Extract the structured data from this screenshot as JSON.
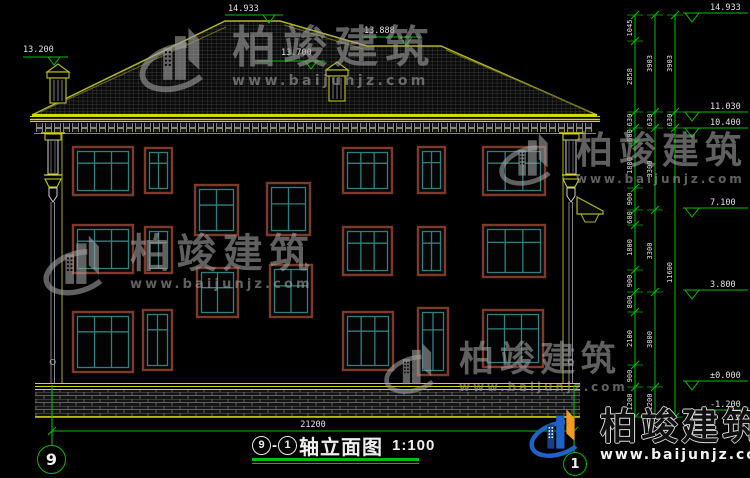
{
  "title_block": {
    "axis_start": "9",
    "separator": "-",
    "axis_end": "1",
    "title": "轴立面图",
    "scale": "1:100"
  },
  "axis_bubbles": [
    {
      "label": "9"
    },
    {
      "label": "1"
    }
  ],
  "watermark": {
    "brand": "柏竣建筑",
    "url": "www.baijunjz.com"
  },
  "colors": {
    "bg": "#000000",
    "green": "#00bf00",
    "label": "#e2e2e2",
    "yellow": "#d6d600",
    "olive": "#b2b226",
    "dim_yellow": "#8f8f20",
    "frame": "#7d3a28",
    "mullion": "#2e8080",
    "dentil": "#969696",
    "brick_line": "#7a7a7a",
    "tile_line": "#3f3f3f",
    "logo_blue": "#1e63c8",
    "logo_dark_blue": "#173f85",
    "logo_orange": "#f49a1c"
  },
  "dims": {
    "bottom": {
      "label": "21200",
      "y": 431,
      "x1": 52,
      "x2": 574
    },
    "axis_lines": [
      {
        "x": 52,
        "y1": 385,
        "y2": 446
      },
      {
        "x": 574,
        "y1": 385,
        "y2": 453
      }
    ],
    "chains": [
      {
        "x": 635,
        "ys": [
          15,
          41,
          112,
          128,
          143,
          188,
          210,
          225,
          270,
          292,
          312,
          365,
          387,
          417
        ],
        "labels": [
          "1045",
          "2858",
          "630",
          "600",
          "1800",
          "900",
          "600",
          "1800",
          "900",
          "800",
          "2100",
          "900",
          "1200"
        ]
      },
      {
        "x": 655,
        "ys": [
          15,
          112,
          128,
          210,
          292,
          387,
          417
        ],
        "labels": [
          "3903",
          "630",
          "3300",
          "3300",
          "3800",
          "1200"
        ]
      },
      {
        "x": 675,
        "ys": [
          15,
          112,
          128,
          417
        ],
        "labels": [
          "3903",
          "630",
          "11600"
        ]
      }
    ]
  },
  "elevations": {
    "right": [
      {
        "label": "14.933",
        "y": 13
      },
      {
        "label": "11.030",
        "y": 112
      },
      {
        "label": "10.400",
        "y": 128
      },
      {
        "label": "7.100",
        "y": 208
      },
      {
        "label": "3.800",
        "y": 290
      },
      {
        "label": "±0.000",
        "y": 381
      },
      {
        "label": "-1.200",
        "y": 410
      }
    ],
    "left": [
      {
        "label": "13.200",
        "tx": 23,
        "ty": 52,
        "x1": 23,
        "x2": 68,
        "y": 57
      },
      {
        "label": "14.933",
        "tx": 228,
        "ty": 11,
        "x1": 225,
        "x2": 283,
        "y": 15
      },
      {
        "label": "13.888",
        "tx": 364,
        "ty": 33,
        "x1": 362,
        "x2": 420,
        "y": 37
      },
      {
        "label": "13.700",
        "tx": 281,
        "ty": 55,
        "x1": 257,
        "x2": 325,
        "y": 61
      }
    ]
  },
  "drawing": {
    "roof": {
      "outline": [
        [
          32,
          115
        ],
        [
          225,
          21
        ],
        [
          280,
          21
        ],
        [
          367,
          46
        ],
        [
          441,
          46
        ],
        [
          597,
          115
        ]
      ],
      "inner_lines": [
        [
          40,
          112,
          226,
          27
        ],
        [
          284,
          25,
          363,
          49
        ],
        [
          446,
          50,
          591,
          112
        ]
      ]
    },
    "chimneys": [
      {
        "cx": 58,
        "top": 64,
        "base": 103
      },
      {
        "cx": 337,
        "top": 62,
        "base": 101
      }
    ],
    "cornice": {
      "x1": 30,
      "x2": 600
    },
    "wall": {
      "x1": 62,
      "x2": 563,
      "top": 134,
      "bottom": 383
    },
    "base": {
      "x1": 35,
      "x2": 580,
      "band_top": 383,
      "brick_top": 390,
      "bottom": 417
    },
    "pilasters": [
      {
        "x": 43
      },
      {
        "x": 561
      }
    ],
    "porch": {
      "roof": [
        [
          577,
          197
        ],
        [
          603,
          211
        ],
        [
          603,
          214
        ],
        [
          577,
          214
        ]
      ],
      "bracket": [
        [
          581,
          214
        ],
        [
          599,
          214
        ],
        [
          595,
          222
        ],
        [
          585,
          222
        ]
      ]
    },
    "windows": [
      {
        "x": 73,
        "y": 147,
        "w": 60,
        "h": 48,
        "t": "L"
      },
      {
        "x": 145,
        "y": 148,
        "w": 27,
        "h": 45,
        "t": "N"
      },
      {
        "x": 343,
        "y": 148,
        "w": 49,
        "h": 45,
        "t": "L"
      },
      {
        "x": 418,
        "y": 147,
        "w": 27,
        "h": 46,
        "t": "N"
      },
      {
        "x": 483,
        "y": 147,
        "w": 62,
        "h": 48,
        "t": "L"
      },
      {
        "x": 195,
        "y": 185,
        "w": 43,
        "h": 50,
        "t": "S"
      },
      {
        "x": 267,
        "y": 183,
        "w": 43,
        "h": 52,
        "t": "S"
      },
      {
        "x": 73,
        "y": 225,
        "w": 60,
        "h": 48,
        "t": "L"
      },
      {
        "x": 145,
        "y": 227,
        "w": 27,
        "h": 46,
        "t": "N"
      },
      {
        "x": 343,
        "y": 227,
        "w": 49,
        "h": 48,
        "t": "L"
      },
      {
        "x": 418,
        "y": 227,
        "w": 27,
        "h": 48,
        "t": "N"
      },
      {
        "x": 483,
        "y": 225,
        "w": 62,
        "h": 52,
        "t": "L"
      },
      {
        "x": 197,
        "y": 268,
        "w": 41,
        "h": 49,
        "t": "S"
      },
      {
        "x": 270,
        "y": 265,
        "w": 42,
        "h": 52,
        "t": "S"
      },
      {
        "x": 73,
        "y": 312,
        "w": 60,
        "h": 60,
        "t": "L"
      },
      {
        "x": 143,
        "y": 310,
        "w": 29,
        "h": 60,
        "t": "N"
      },
      {
        "x": 343,
        "y": 312,
        "w": 50,
        "h": 58,
        "t": "L"
      },
      {
        "x": 418,
        "y": 308,
        "w": 30,
        "h": 67,
        "t": "N"
      },
      {
        "x": 483,
        "y": 310,
        "w": 60,
        "h": 57,
        "t": "L"
      }
    ]
  }
}
